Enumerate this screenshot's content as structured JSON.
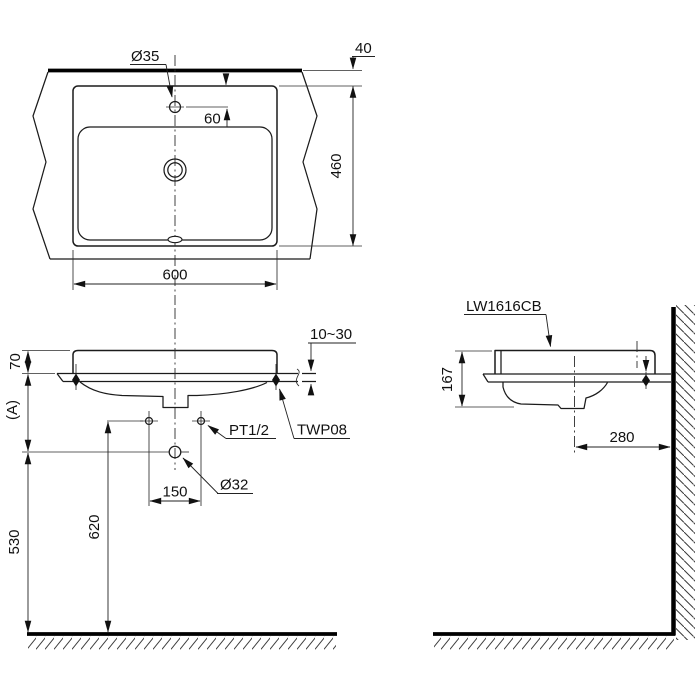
{
  "product": {
    "model": "LW1616CB"
  },
  "views": {
    "top": {
      "faucet_hole_dia": "Ø35",
      "rim_to_counter_edge": "40",
      "faucet_center_offset": "60",
      "depth": "460",
      "width": "600"
    },
    "front": {
      "rim_above_counter": "70",
      "counter_height_label": "(A)",
      "counter_thickness_range": "10~30",
      "clip_model": "TWP08",
      "supply_connection": "PT1/2",
      "drain_hole_dia": "Ø32",
      "supply_hole_spacing": "150",
      "supply_height_above_floor": "620",
      "drain_height_above_floor": "530"
    },
    "side": {
      "model_label": "LW1616CB",
      "basin_height": "167",
      "drain_center_to_wall": "280"
    }
  }
}
